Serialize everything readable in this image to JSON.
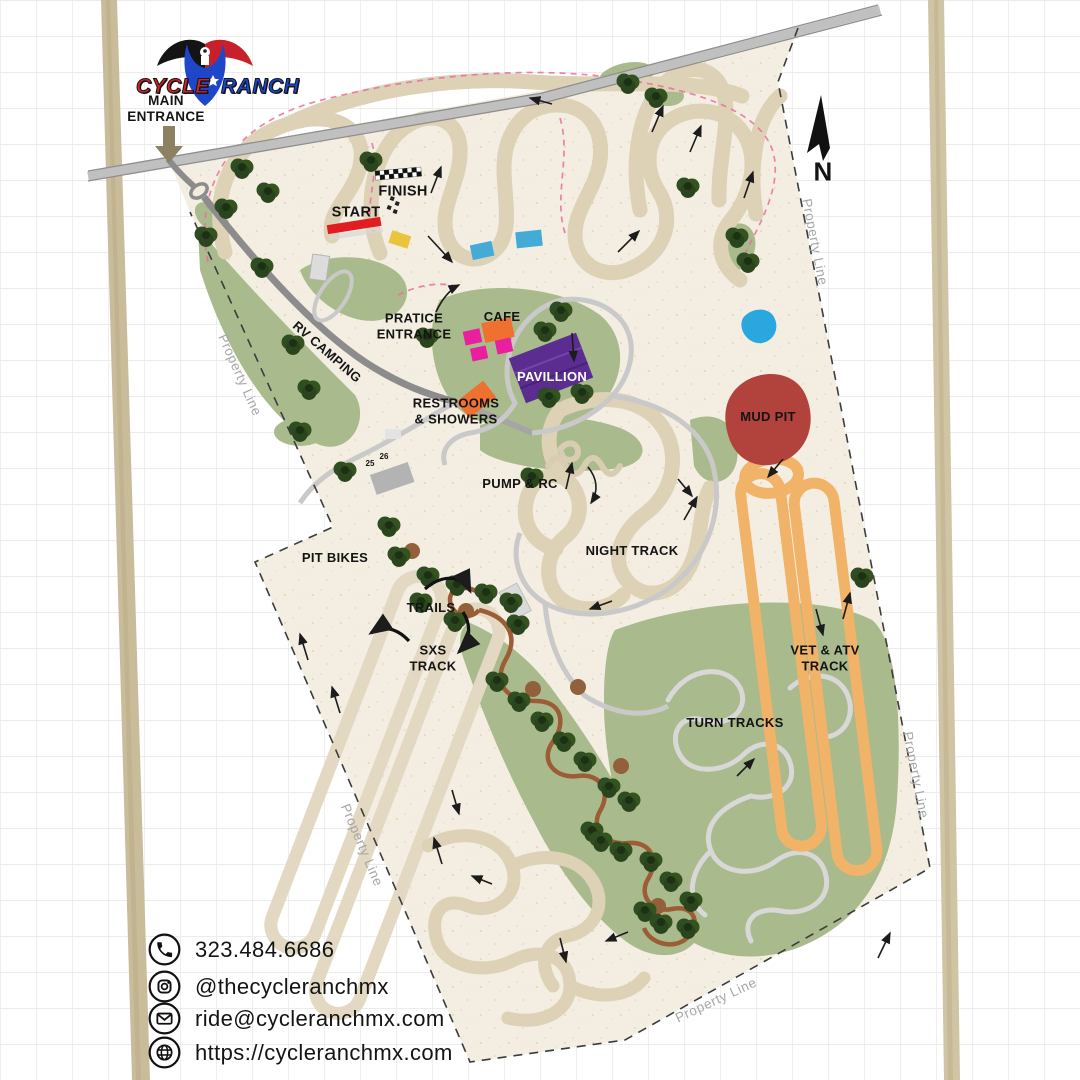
{
  "logo": {
    "word_left": "CYCLE",
    "word_right": "RANCH"
  },
  "entrance": {
    "label": "MAIN\nENTRANCE"
  },
  "compass": {
    "label": "N"
  },
  "track_labels": {
    "start": "START",
    "finish": "FINISH",
    "practice_entrance": "PRATICE\nENTRANCE",
    "cafe": "CAFE",
    "pavilion": "PAVILLION",
    "restrooms": "RESTROOMS\n& SHOWERS",
    "rv_camping": "RV CAMPING",
    "pump_rc": "PUMP & RC",
    "night_track": "NIGHT TRACK",
    "mud_pit": "MUD PIT",
    "pit_bikes": "PIT BIKES",
    "trails": "TRAILS",
    "sxs_track": "SXS\nTRACK",
    "vet_atv": "VET & ATV\nTRACK",
    "turn_tracks": "TURN TRACKS"
  },
  "site_numbers": {
    "n25": "25",
    "n26": "26"
  },
  "property_line_label": "Property Line",
  "contact": {
    "phone": "323.484.6686",
    "instagram": "@thecycleranchmx",
    "email": "ride@cycleranchmx.com",
    "website": "https://cycleranchmx.com"
  },
  "colors": {
    "property_fill": "#f3eee1",
    "track_tan": "#ddd1b6",
    "green_field": "#a9ba8c",
    "tree_green": "#2f4d22",
    "road_dark": "#8c8c8c",
    "road_light": "#c9c9c9",
    "mud_pit_red": "#b2433c",
    "pond_blue": "#2aa7df",
    "vet_track_orange": "#f1b368",
    "trail_brown": "#9c5c35",
    "pink_dash": "#ea6f9f",
    "start_red": "#e21d22",
    "cafe_orange": "#ee7130",
    "pavilion_purple": "#5b2d90",
    "magenta_building": "#ea1f9f",
    "logo_red": "#d42027",
    "logo_blue": "#1b46d6"
  }
}
